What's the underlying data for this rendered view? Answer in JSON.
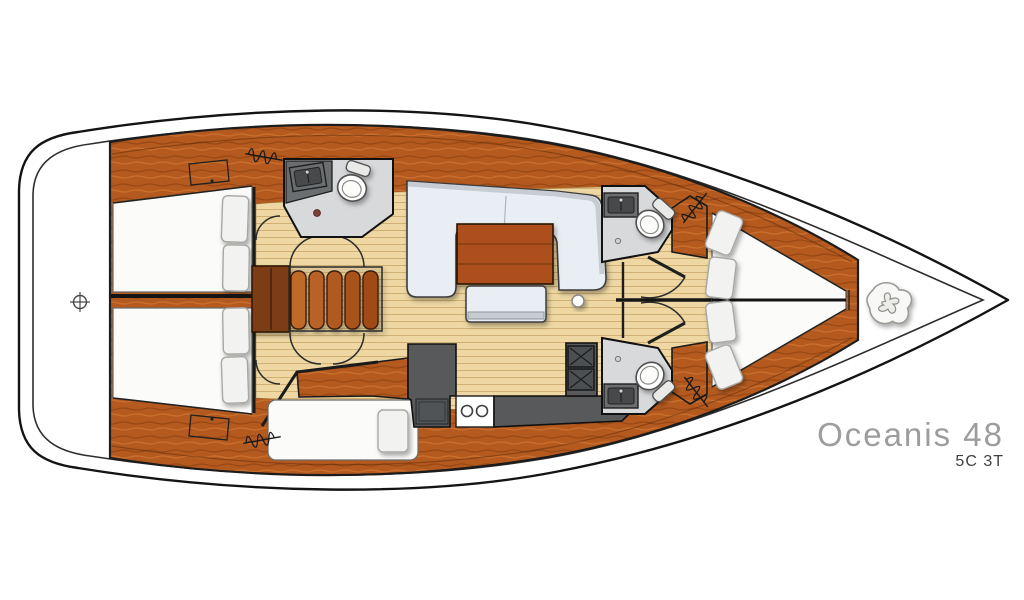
{
  "branding": {
    "model": "Oceanis 48",
    "layout_code": "5C 3T"
  },
  "palette": {
    "page_bg": "#ffffff",
    "hull_line": "#161616",
    "deck": "#ffffff",
    "wood": "#b55a1f",
    "wood_dark": "#7c3c13",
    "floor": "#eed7a2",
    "floor_stripe": "#d9b97c",
    "upholstery": "#e9eef4",
    "upholstery_edge": "#c6ccd2",
    "berth": "#fbfbfa",
    "pillow": "#f2f2f0",
    "head_floor": "#d7d9da",
    "counter": "#6b6e70",
    "sink": "#47494b",
    "galley_counter": "#57595a",
    "table_wood": "#ad4f1b",
    "model_text": "#9d9d9d",
    "code_text": "#3f3f3f"
  },
  "icons": {
    "steering_crosshair": "⊕",
    "mast_foot": "●",
    "hatch_vent_coil": "〰",
    "windlass": "✣",
    "stove_burner": "✕"
  }
}
